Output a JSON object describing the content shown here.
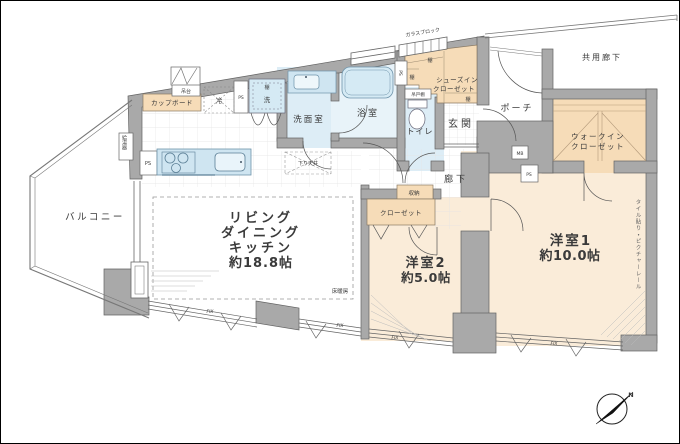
{
  "floorplan": {
    "colors": {
      "wall": "#a9a9a9",
      "room_cream": "#faecd9",
      "storage_peach": "#f6dcb8",
      "water_blue": "#ddedf6",
      "line_dark": "#555555"
    },
    "rooms": {
      "ldk": {
        "line1": "リビング",
        "line2": "ダイニング",
        "line3": "キッチン",
        "size": "約18.8帖"
      },
      "bedroom1": {
        "name": "洋室1",
        "size": "約10.0帖"
      },
      "bedroom2": {
        "name": "洋室2",
        "size": "約5.0帖"
      },
      "balcony": {
        "name": "バルコニー"
      },
      "washroom": {
        "name": "洗面室"
      },
      "bathroom": {
        "name": "浴室"
      },
      "toilet": {
        "name": "トイレ"
      },
      "entrance": {
        "name": "玄関"
      },
      "porch": {
        "name": "ポーチ"
      },
      "hallway": {
        "name": "廊下"
      },
      "common_corridor": {
        "name": "共用廊下"
      },
      "walk_in_closet": {
        "line1": "ウォークイン",
        "line2": "クローゼット"
      },
      "shoes_in_closet": {
        "line1": "シューズイン",
        "line2": "クローゼット"
      },
      "closet": {
        "name": "クローゼット"
      },
      "storage": {
        "name": "収納"
      }
    },
    "fixtures": {
      "cupboard": "カップボード",
      "hanging_unit": "吊台",
      "hanging_cabinet": "吊戸棚",
      "shelf": "棚",
      "refrigerator": "冷",
      "washer": "洗",
      "water_heater": "給湯器",
      "floor_heating": "床暖房",
      "lowered_ceiling": "下り天井",
      "glass_block": "ガラスブロック",
      "wall_finish": "タイル貼り・ピクチャーレール",
      "meter_box": "MB",
      "pipe_space": "PS",
      "fix_window": "FIX",
      "north_mark": "N"
    }
  }
}
